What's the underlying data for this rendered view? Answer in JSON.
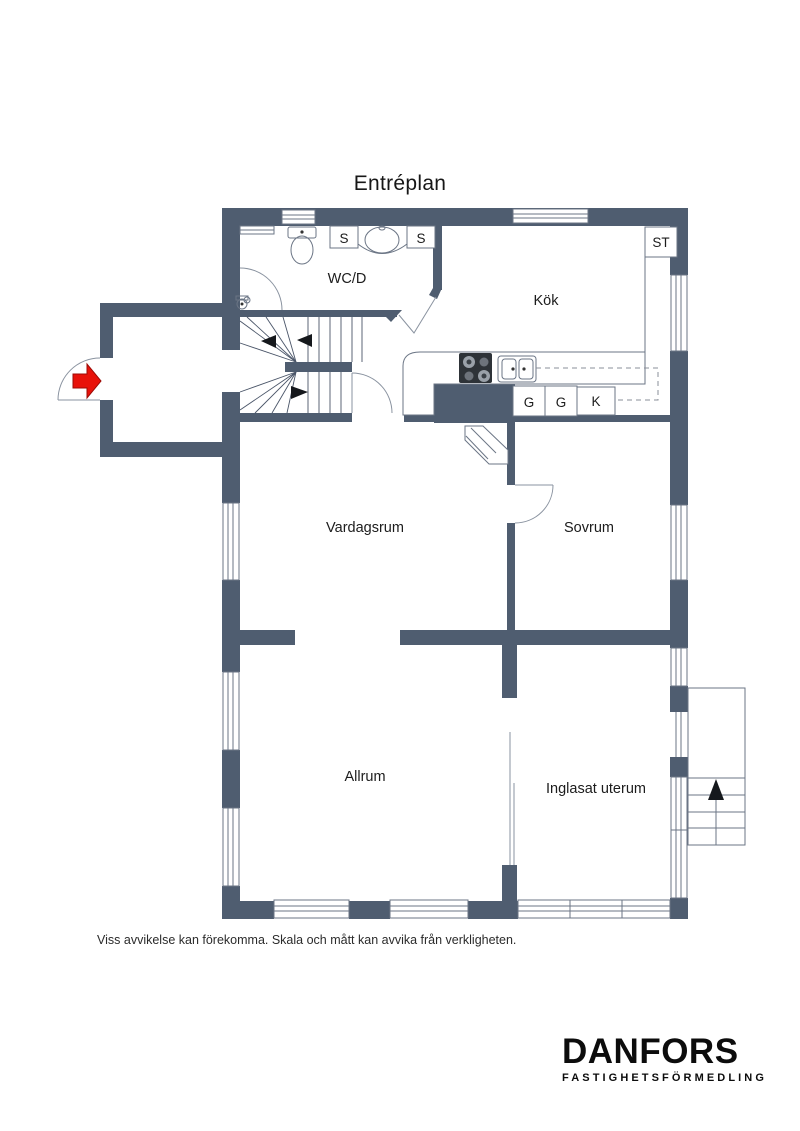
{
  "title": "Entréplan",
  "colors": {
    "wall": "#4f5d70",
    "line": "#6b7585",
    "red": "#e8120a"
  },
  "rooms": {
    "wc": "WC/D",
    "kok": "Kök",
    "vardagsrum": "Vardagsrum",
    "sovrum": "Sovrum",
    "allrum": "Allrum",
    "uterum": "Inglasat uterum"
  },
  "closets": {
    "st": "ST",
    "s1": "S",
    "s2": "S",
    "g1": "G",
    "g2": "G",
    "k": "K"
  },
  "disclaimer": "Viss avvikelse kan förekomma. Skala och mått kan avvika från verkligheten.",
  "logo": {
    "name": "DANFORS",
    "tagline": "FASTIGHETSFÖRMEDLING"
  }
}
